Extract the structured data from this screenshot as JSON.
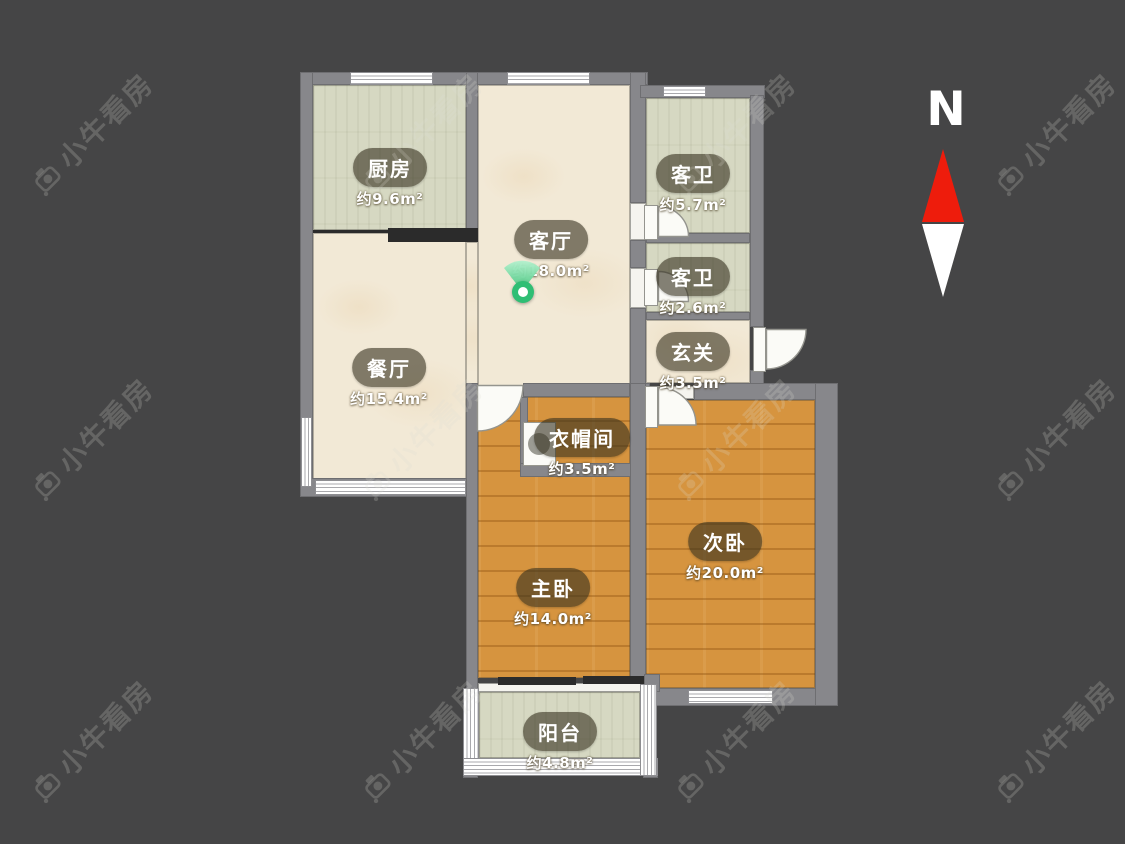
{
  "watermark": {
    "text": "小牛看房"
  },
  "compass": {
    "label": "N",
    "arrow_up_color": "#ee1c0c",
    "arrow_down_color": "#ffffff"
  },
  "pin": {
    "color": "#2fbe74"
  },
  "rooms": [
    {
      "id": "kitchen",
      "name": "厨房",
      "area": "约9.6m²"
    },
    {
      "id": "living",
      "name": "客厅",
      "area": "约18.0m²"
    },
    {
      "id": "dining",
      "name": "餐厅",
      "area": "约15.4m²"
    },
    {
      "id": "bath1",
      "name": "客卫",
      "area": "约5.7m²"
    },
    {
      "id": "bath2",
      "name": "客卫",
      "area": "约2.6m²"
    },
    {
      "id": "foyer",
      "name": "玄关",
      "area": "约3.5m²"
    },
    {
      "id": "cloakroom",
      "name": "衣帽间",
      "area": "约3.5m²"
    },
    {
      "id": "master",
      "name": "主卧",
      "area": "约14.0m²"
    },
    {
      "id": "second",
      "name": "次卧",
      "area": "约20.0m²"
    },
    {
      "id": "balcony",
      "name": "阳台",
      "area": "约4.8m²"
    }
  ],
  "colors": {
    "bg": "#454546",
    "wall": "#87878b",
    "wall-dark": "#2b2b2b",
    "tile": "#d6d8c2",
    "cream": "#f2e9d6",
    "wood": "#d6943f",
    "pin": "#2fbe74",
    "red": "#ee1c0c",
    "white": "#ffffff"
  }
}
